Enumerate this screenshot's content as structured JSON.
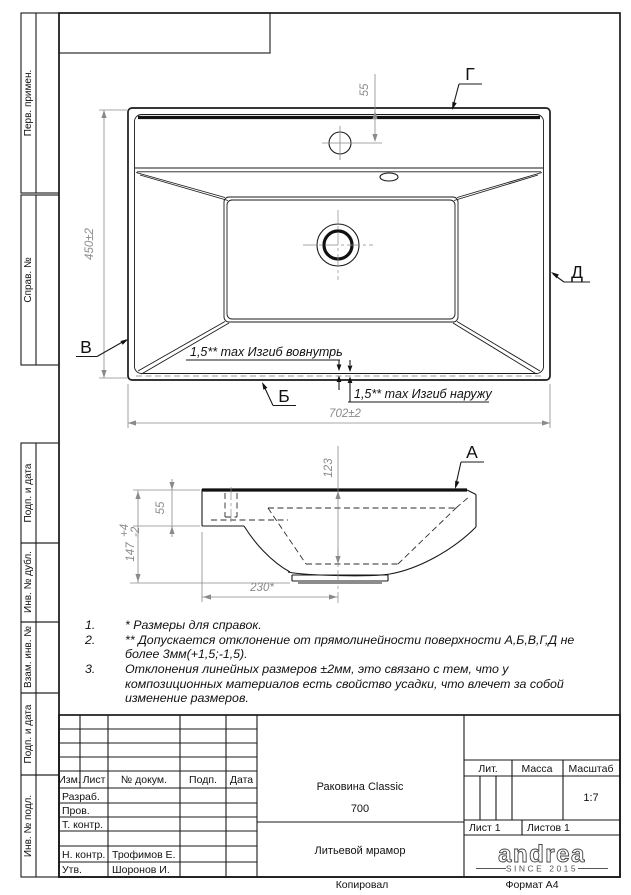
{
  "sheet": {
    "copied": "Копировал",
    "format": "Формат А4"
  },
  "side_strip": {
    "cells": [
      "Перв. примен.",
      "Справ. №",
      "Подп. и дата",
      "Инв. № дубл.",
      "Взам. инв. №",
      "Подп. и дата",
      "Инв. № подл."
    ]
  },
  "plan_view": {
    "dim_height": "450±2",
    "dim_width": "702±2",
    "dim_faucet": "55",
    "label_top": "Г",
    "label_right": "Д",
    "label_left": "В",
    "label_bottom": "Б",
    "note_inward": "1,5** max Изгиб вовнутрь",
    "note_outward": "1,5** max Изгиб наружу"
  },
  "side_view": {
    "label": "А",
    "dim_depth": "123",
    "dim_deck": "55",
    "dim_total": "147",
    "dim_total_tol_up": "+4",
    "dim_total_tol_dn": "-2",
    "dim_drain": "230*"
  },
  "notes": {
    "items": [
      {
        "num": "1.",
        "text": "*  Размеры для справок."
      },
      {
        "num": "2.",
        "text": "**  Допускается отклонение от прямолинейности поверхности А,Б,В,Г,Д не более 3мм(+1,5;-1,5)."
      },
      {
        "num": "3.",
        "text": "Отклонения линейных размеров ±2мм, это связано с тем, что у композиционных материалов есть свойство усадки, что влечет за собой изменение размеров."
      }
    ]
  },
  "title_block": {
    "header_cols": [
      "Изм.",
      "Лист",
      "№ докум.",
      "Подп.",
      "Дата"
    ],
    "rows": [
      {
        "label": "Разраб.",
        "name": ""
      },
      {
        "label": "Пров.",
        "name": ""
      },
      {
        "label": "Т. контр.",
        "name": ""
      },
      {
        "label": "",
        "name": ""
      },
      {
        "label": "Н. контр.",
        "name": "Трофимов Е."
      },
      {
        "label": "Утв.",
        "name": "Шоронов И."
      }
    ],
    "title_line1": "Раковина Classic",
    "title_line2": "700",
    "lit_label": "Лит.",
    "mass_label": "Масса",
    "scale_label": "Масштаб",
    "scale_value": "1:7",
    "sheet_label": "Лист 1",
    "sheets_label": "Листов 1",
    "material": "Литьевой мрамор",
    "logo_text": "andrea",
    "logo_sub": "SINCE 2015"
  }
}
